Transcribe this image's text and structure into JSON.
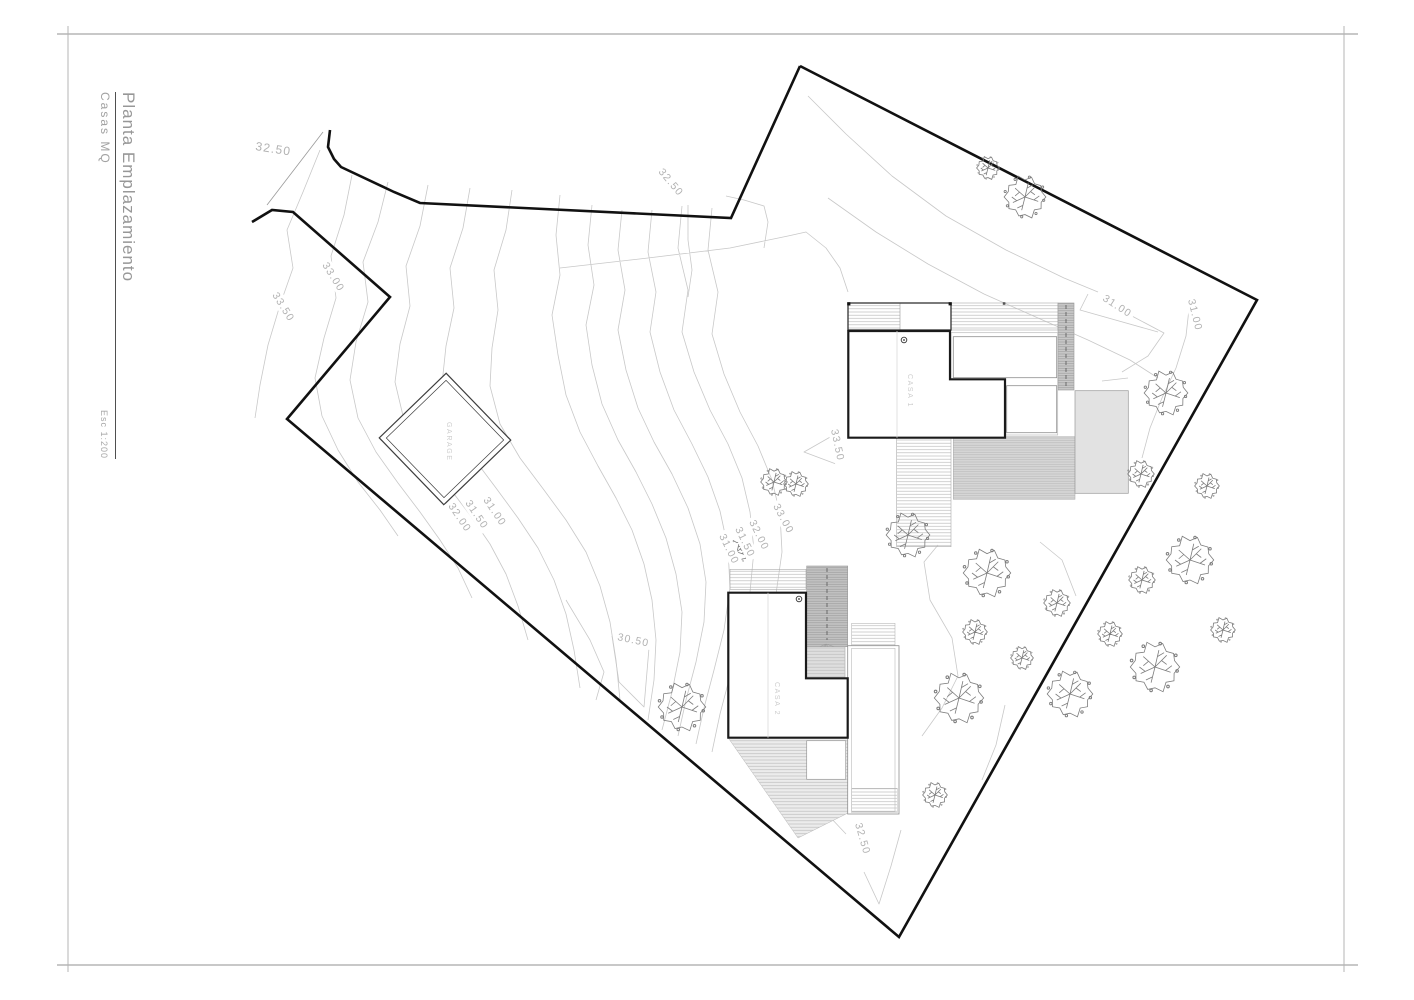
{
  "sheet": {
    "title": "Planta Emplazamiento",
    "subtitle": "Casas  MQ",
    "scale": "Esc 1:200"
  },
  "buildings": {
    "casa1": {
      "label": "CASA 1"
    },
    "casa2": {
      "label": "CASA 2"
    },
    "garage": {
      "label": "GARAGE"
    }
  },
  "contour_labels": [
    {
      "text": "32.50"
    },
    {
      "text": "32.50"
    },
    {
      "text": "33.00"
    },
    {
      "text": "33.50"
    },
    {
      "text": "32.00"
    },
    {
      "text": "31.50"
    },
    {
      "text": "31.00"
    },
    {
      "text": "31.00"
    },
    {
      "text": "31.50"
    },
    {
      "text": "32.00"
    },
    {
      "text": "33.00"
    },
    {
      "text": "33.50"
    },
    {
      "text": "30.50"
    },
    {
      "text": "31.00"
    },
    {
      "text": "31.00"
    },
    {
      "text": "32.50"
    }
  ],
  "colors": {
    "boundary": "#111111",
    "building_outline": "#1a1a1a",
    "contour": "#c8c8c8",
    "contour_label": "#b2b2b2",
    "deck_hatch": "#bdbdbd",
    "ramp_fill": "#c3c3c3",
    "deck_fill": "#d7d7d7",
    "frame": "#b5b5b5",
    "title_text": "#979797"
  }
}
